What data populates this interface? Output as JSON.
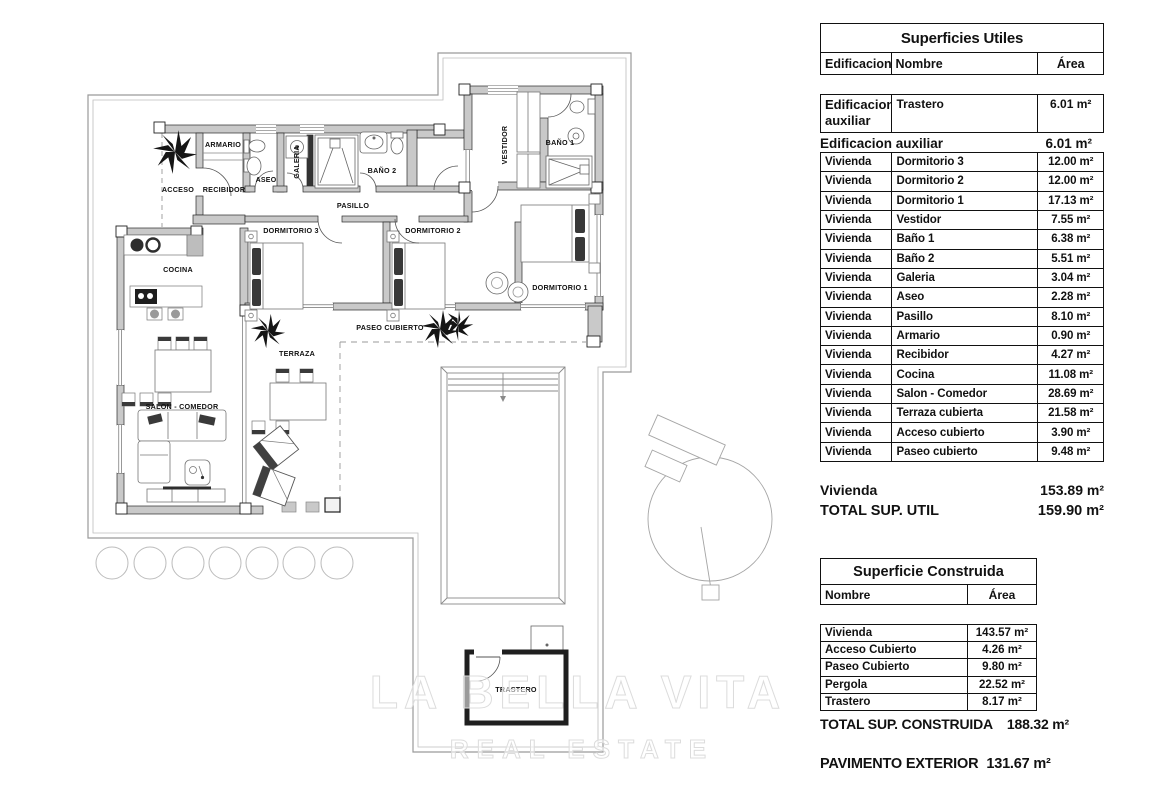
{
  "plan": {
    "labels": [
      {
        "id": "armario",
        "text": "ARMARIO"
      },
      {
        "id": "acceso",
        "text": "ACCESO"
      },
      {
        "id": "recibidor",
        "text": "RECIBIDOR"
      },
      {
        "id": "aseo",
        "text": "ASEO"
      },
      {
        "id": "galeria",
        "text": "GALERIA"
      },
      {
        "id": "bano2",
        "text": "BAÑO 2"
      },
      {
        "id": "pasillo",
        "text": "PASILLO"
      },
      {
        "id": "vestidor",
        "text": "VESTIDOR"
      },
      {
        "id": "bano1",
        "text": "BAÑO 1"
      },
      {
        "id": "dormitorio3",
        "text": "DORMITORIO 3"
      },
      {
        "id": "dormitorio2",
        "text": "DORMITORIO 2"
      },
      {
        "id": "dormitorio1",
        "text": "DORMITORIO 1"
      },
      {
        "id": "cocina",
        "text": "COCINA"
      },
      {
        "id": "salon",
        "text": "SALON - COMEDOR"
      },
      {
        "id": "terraza",
        "text": "TERRAZA"
      },
      {
        "id": "paseo",
        "text": "PASEO CUBIERTO"
      },
      {
        "id": "trastero",
        "text": "TRASTERO"
      }
    ],
    "watermark": {
      "line1": "LA BELLA VITA",
      "line2": "REAL ESTATE"
    },
    "colors": {
      "wall": "#c9c9c9",
      "line": "#2a2a2a",
      "boundary": "#9a9a9a",
      "dashed": "#999999"
    }
  },
  "tables": {
    "utiles": {
      "title": "Superficies Utiles",
      "columns": [
        "Edificacion",
        "Nombre",
        "Área"
      ],
      "aux_row": {
        "e": "Edificacion auxiliar",
        "n": "Trastero",
        "a": "6.01 m²"
      },
      "aux_total": {
        "label": "Edificacion auxiliar",
        "value": "6.01 m²"
      },
      "rows": [
        {
          "e": "Vivienda",
          "n": "Dormitorio 3",
          "a": "12.00 m²"
        },
        {
          "e": "Vivienda",
          "n": "Dormitorio 2",
          "a": "12.00 m²"
        },
        {
          "e": "Vivienda",
          "n": "Dormitorio 1",
          "a": "17.13 m²"
        },
        {
          "e": "Vivienda",
          "n": "Vestidor",
          "a": "7.55 m²"
        },
        {
          "e": "Vivienda",
          "n": "Baño 1",
          "a": "6.38 m²"
        },
        {
          "e": "Vivienda",
          "n": "Baño 2",
          "a": "5.51 m²"
        },
        {
          "e": "Vivienda",
          "n": "Galeria",
          "a": "3.04 m²"
        },
        {
          "e": "Vivienda",
          "n": "Aseo",
          "a": "2.28 m²"
        },
        {
          "e": "Vivienda",
          "n": "Pasillo",
          "a": "8.10 m²"
        },
        {
          "e": "Vivienda",
          "n": "Armario",
          "a": "0.90 m²"
        },
        {
          "e": "Vivienda",
          "n": "Recibidor",
          "a": "4.27 m²"
        },
        {
          "e": "Vivienda",
          "n": "Cocina",
          "a": "11.08 m²"
        },
        {
          "e": "Vivienda",
          "n": "Salon - Comedor",
          "a": "28.69 m²"
        },
        {
          "e": "Vivienda",
          "n": "Terraza cubierta",
          "a": "21.58 m²"
        },
        {
          "e": "Vivienda",
          "n": "Acceso cubierto",
          "a": "3.90 m²"
        },
        {
          "e": "Vivienda",
          "n": "Paseo cubierto",
          "a": "9.48 m²"
        }
      ],
      "vivienda_total": {
        "label": "Vivienda",
        "value": "153.89 m²"
      },
      "total": {
        "label": "TOTAL SUP. UTIL",
        "value": "159.90 m²"
      }
    },
    "construida": {
      "title": "Superficie Construida",
      "columns": [
        "Nombre",
        "Área"
      ],
      "rows": [
        {
          "n": "Vivienda",
          "a": "143.57 m²"
        },
        {
          "n": "Acceso Cubierto",
          "a": "4.26 m²"
        },
        {
          "n": "Paseo Cubierto",
          "a": "9.80 m²"
        },
        {
          "n": "Pergola",
          "a": "22.52 m²"
        },
        {
          "n": "Trastero",
          "a": "8.17 m²"
        }
      ],
      "total": {
        "label": "TOTAL SUP. CONSTRUIDA",
        "value": "188.32 m²"
      },
      "pavimento": {
        "label": "PAVIMENTO EXTERIOR",
        "value": "131.67 m²"
      }
    }
  }
}
